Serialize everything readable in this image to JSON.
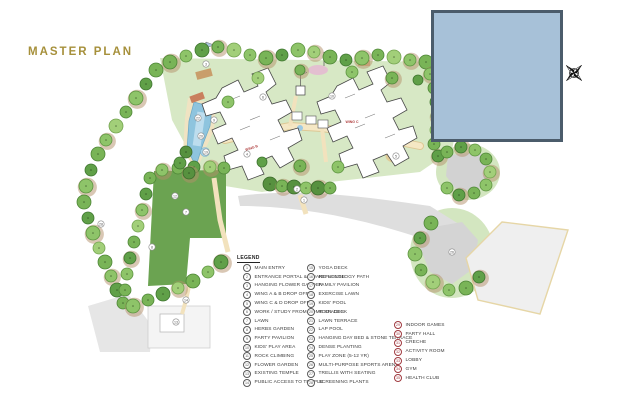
{
  "title": "MASTER PLAN",
  "colors": {
    "title_gold": "#a6903b",
    "inset_fill": "#a7c1d8",
    "inset_border": "#4b5c6b",
    "lawn_green": "#6ba351",
    "ground_green": "#d7e8c5",
    "pool_blue": "#8ec4de",
    "path_cream": "#f2e2bd",
    "road_gray": "#dedede",
    "tree_green": "#6fae4f",
    "legend_number_dark": "#5a5a5a",
    "legend_number_red": "#a03a40"
  },
  "plan": {
    "wing_labels": [
      {
        "text": "WING B",
        "x": 252,
        "y": 149,
        "rot": -18
      },
      {
        "text": "WING C",
        "x": 352,
        "y": 123,
        "rot": 0
      }
    ],
    "markers": [
      {
        "n": "1",
        "x": 304,
        "y": 200
      },
      {
        "n": "2",
        "x": 297,
        "y": 189
      },
      {
        "n": "3",
        "x": 206,
        "y": 64
      },
      {
        "n": "4",
        "x": 247,
        "y": 154
      },
      {
        "n": "5",
        "x": 396,
        "y": 156
      },
      {
        "n": "6",
        "x": 263,
        "y": 97
      },
      {
        "n": "7",
        "x": 186,
        "y": 212
      },
      {
        "n": "8",
        "x": 152,
        "y": 247
      },
      {
        "n": "9",
        "x": 214,
        "y": 120
      },
      {
        "n": "10",
        "x": 332,
        "y": 96
      },
      {
        "n": "12",
        "x": 175,
        "y": 196
      },
      {
        "n": "13",
        "x": 176,
        "y": 322
      },
      {
        "n": "14",
        "x": 186,
        "y": 300
      },
      {
        "n": "19",
        "x": 206,
        "y": 152
      },
      {
        "n": "20",
        "x": 201,
        "y": 136
      },
      {
        "n": "22",
        "x": 198,
        "y": 118
      },
      {
        "n": "26",
        "x": 452,
        "y": 252
      },
      {
        "n": "28",
        "x": 101,
        "y": 224
      }
    ]
  },
  "legend": {
    "header": "LEGEND",
    "columns": [
      {
        "circle_color": "#5a5a5a",
        "items": [
          {
            "n": "1",
            "label": "MAIN ENTRY"
          },
          {
            "n": "2",
            "label": "ENTRANCE PORTAL & GUARD HOUSE"
          },
          {
            "n": "3",
            "label": "HANGING FLOWER GARDEN"
          },
          {
            "n": "4",
            "label": "WING A & B DROP OFF"
          },
          {
            "n": "5",
            "label": "WING C & D DROP OFF"
          },
          {
            "n": "6",
            "label": "WORK / STUDY FROM HOME SPACES"
          },
          {
            "n": "7",
            "label": "LAWN"
          },
          {
            "n": "8",
            "label": "HERBS GARDEN"
          },
          {
            "n": "9",
            "label": "PARTY PAVILION"
          },
          {
            "n": "10",
            "label": "KIDS' PLAY AREA"
          },
          {
            "n": "11",
            "label": "ROCK CLIMBING"
          },
          {
            "n": "12",
            "label": "FLOWER GARDEN"
          },
          {
            "n": "13",
            "label": "EXISTING TEMPLE"
          },
          {
            "n": "14",
            "label": "PUBLIC ACCESS TO TEMPLE"
          }
        ]
      },
      {
        "circle_color": "#5a5a5a",
        "items": [
          {
            "n": "15",
            "label": "YOGA DECK"
          },
          {
            "n": "16",
            "label": "REFLEXOLOGY PATH"
          },
          {
            "n": "17",
            "label": "FAMILY PAVILION"
          },
          {
            "n": "18",
            "label": "EXERCISE LAWN"
          },
          {
            "n": "19",
            "label": "KIDS' POOL"
          },
          {
            "n": "20",
            "label": "POOL DECK"
          },
          {
            "n": "21",
            "label": "LAWN TERRACE"
          },
          {
            "n": "22",
            "label": "LAP POOL"
          },
          {
            "n": "23",
            "label": "HANGING DAY BED & STONE TERRACE"
          },
          {
            "n": "24",
            "label": "DENSE PLANTING"
          },
          {
            "n": "25",
            "label": "PLAY ZONE (5-12 YR)"
          },
          {
            "n": "26",
            "label": "MULTI-PURPOSE SPORTS ARENA"
          },
          {
            "n": "27",
            "label": "TRELLIS WITH SEATING"
          },
          {
            "n": "28",
            "label": "SCREENING PLANTS"
          }
        ]
      },
      {
        "circle_color": "#a03a40",
        "items": [
          {
            "n": "29",
            "label": "INDOOR GAMES"
          },
          {
            "n": "30",
            "label": "PARTY HALL"
          },
          {
            "n": "31",
            "label": "CRECHE"
          },
          {
            "n": "32",
            "label": "ACTIVITY ROOM"
          },
          {
            "n": "33",
            "label": "LOBBY"
          },
          {
            "n": "34",
            "label": "GYM"
          },
          {
            "n": "35",
            "label": "HEALTH CLUB"
          }
        ]
      }
    ]
  }
}
